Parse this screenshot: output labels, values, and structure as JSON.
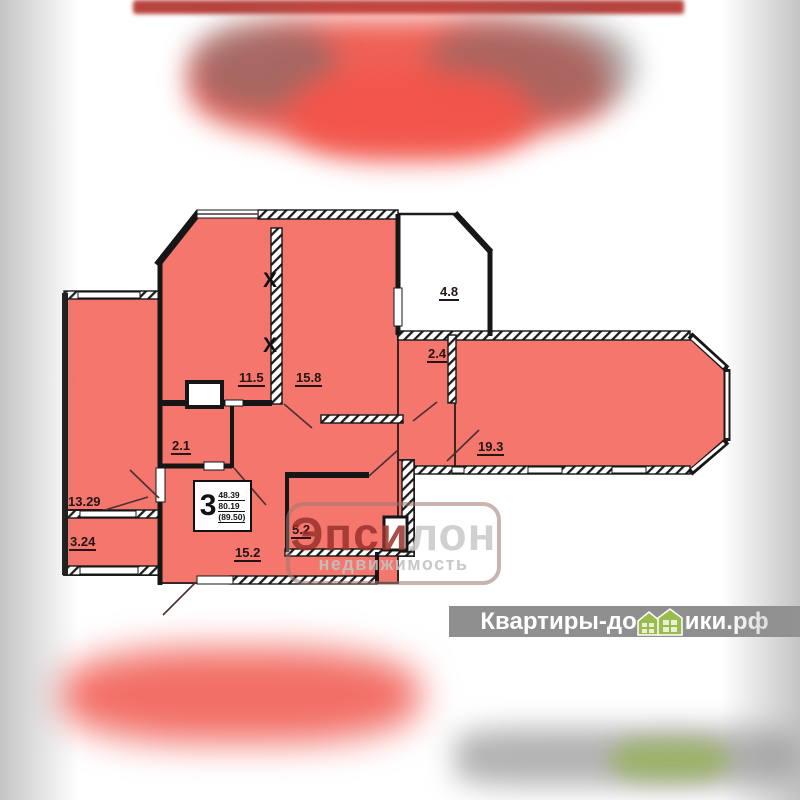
{
  "plan": {
    "labels": {
      "r11_5": "11.5",
      "r15_8": "15.8",
      "r2_4": "2.4",
      "r4_8": "4.8",
      "r19_3": "19.3",
      "r2_1": "2.1",
      "r13_29": "13.29",
      "r3_24": "3.24",
      "r5_2": "5.2",
      "r15_2": "15.2"
    },
    "marks": {
      "x_upper": "X",
      "x_lower": "X"
    },
    "stamp": {
      "rooms": "3",
      "living_area": "48.39",
      "total_area": "80.19",
      "total_with_balcony": "(89.50)"
    }
  },
  "watermarks": {
    "agency": {
      "name_left": "Эпси",
      "name_right": "лон",
      "subtitle": "недвижимость"
    },
    "site": {
      "prefix": "Квартиры-до",
      "suffix": "ики.рф"
    }
  },
  "colors": {
    "room_fill": "#f4766c",
    "wall": "#161616",
    "site_strip": "#8f8f8f",
    "house_icon_green": "#9cbb4e",
    "agency_red": "#98332c",
    "top_band_red": "#b8433e"
  }
}
